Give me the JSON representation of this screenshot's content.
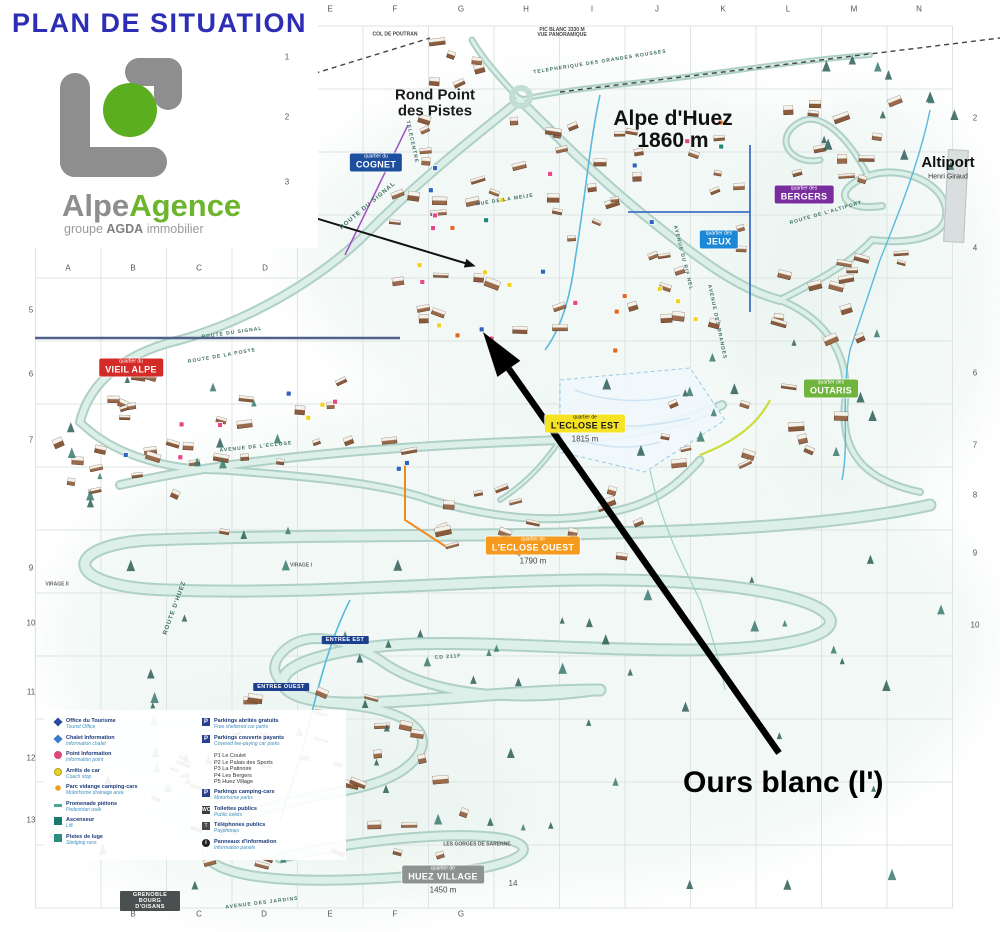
{
  "header": {
    "title": "PLAN DE SITUATION",
    "logo": {
      "name1": "Alpe",
      "name2": "Agence",
      "sub_pre": "groupe ",
      "sub_bold": "AGDA",
      "sub_post": " immobilier"
    }
  },
  "annotation": {
    "label": "Ours blanc (l')",
    "x": 683,
    "y": 766,
    "arrow": {
      "x1": 779,
      "y1": 753,
      "x2": 483,
      "y2": 332
    },
    "pointer_points": [
      [
        222,
        148
      ],
      [
        222,
        190
      ],
      [
        468,
        264
      ]
    ]
  },
  "map": {
    "places": [
      {
        "id": "rond-point",
        "lines": [
          "Rond Point",
          "des Pistes"
        ],
        "x": 435,
        "y": 103,
        "size": 15,
        "weight": "600",
        "color": "#1a1a1a"
      },
      {
        "id": "alpe-dhuez",
        "lines": [
          "Alpe d'Huez",
          "1860 m"
        ],
        "x": 673,
        "y": 130,
        "size": 21,
        "weight": "bold",
        "color": "#111"
      },
      {
        "id": "altiport",
        "lines": [
          "Altiport"
        ],
        "x": 948,
        "y": 163,
        "size": 15,
        "weight": "bold",
        "color": "#111"
      },
      {
        "id": "altiport-sub",
        "lines": [
          "Henri Giraud"
        ],
        "x": 948,
        "y": 177,
        "size": 7,
        "weight": "normal",
        "color": "#333"
      },
      {
        "id": "col-de-poutran",
        "lines": [
          "COL DE POUTRAN"
        ],
        "x": 395,
        "y": 35,
        "size": 5,
        "weight": "bold",
        "color": "#444"
      },
      {
        "id": "pic-blanc",
        "lines": [
          "PIC BLANC 3330 M",
          "VUE PANORAMIQUE"
        ],
        "x": 562,
        "y": 33,
        "size": 5,
        "weight": "bold",
        "color": "#444"
      },
      {
        "id": "gorges-sarenne",
        "lines": [
          "LES GORGES DE SARENNE"
        ],
        "x": 477,
        "y": 845,
        "size": 5,
        "weight": "bold",
        "color": "#555"
      },
      {
        "id": "virage-2",
        "lines": [
          "VIRAGE II"
        ],
        "x": 57,
        "y": 585,
        "size": 5,
        "weight": "bold",
        "color": "#666"
      },
      {
        "id": "virage-1",
        "lines": [
          "VIRAGE I"
        ],
        "x": 301,
        "y": 566,
        "size": 5,
        "weight": "bold",
        "color": "#666"
      },
      {
        "id": "inner-14",
        "lines": [
          "14"
        ],
        "x": 513,
        "y": 884,
        "size": 8,
        "weight": "normal",
        "color": "#555"
      }
    ],
    "road_labels": [
      {
        "text": "TELEPHERIQUE DES GRANDES ROUSSES",
        "x": 600,
        "y": 62,
        "rot": -9,
        "size": 5
      },
      {
        "text": "TELECENTRE",
        "x": 412,
        "y": 142,
        "rot": 78,
        "size": 5
      },
      {
        "text": "ROUTE DU SIGNAL",
        "x": 368,
        "y": 206,
        "rot": -40,
        "size": 6
      },
      {
        "text": "ROUTE DU SIGNAL",
        "x": 232,
        "y": 333,
        "rot": -8,
        "size": 5
      },
      {
        "text": "ROUTE DE LA POSTE",
        "x": 222,
        "y": 356,
        "rot": -10,
        "size": 5
      },
      {
        "text": "RUE DE LA MEIJE",
        "x": 505,
        "y": 200,
        "rot": -9,
        "size": 5
      },
      {
        "text": "AVENUE DU RIF NEL",
        "x": 683,
        "y": 258,
        "rot": 76,
        "size": 5
      },
      {
        "text": "AVENUE DES BRANDES",
        "x": 717,
        "y": 322,
        "rot": 78,
        "size": 5
      },
      {
        "text": "AVENUE DE L'ECLOSE",
        "x": 256,
        "y": 447,
        "rot": -6,
        "size": 5
      },
      {
        "text": "ROUTE DE L'ALTIPORT",
        "x": 826,
        "y": 213,
        "rot": -16,
        "size": 5
      },
      {
        "text": "ROUTE D'HUEZ",
        "x": 175,
        "y": 608,
        "rot": -70,
        "size": 6
      },
      {
        "text": "AVENUE DES JARDINS",
        "x": 262,
        "y": 903,
        "rot": -7,
        "size": 5
      },
      {
        "text": "CD 211F",
        "x": 448,
        "y": 657,
        "rot": -4,
        "size": 5
      }
    ],
    "quarters": [
      {
        "id": "cognet",
        "small": "quartier du",
        "name": "COGNET",
        "bg": "#1d4f9e",
        "fg": "#ffffff",
        "x": 376,
        "y": 163
      },
      {
        "id": "jeux",
        "small": "quartier des",
        "name": "JEUX",
        "bg": "#1b87d6",
        "fg": "#ffffff",
        "x": 719,
        "y": 240
      },
      {
        "id": "bergers",
        "small": "quartier des",
        "name": "BERGERS",
        "bg": "#7a2d9e",
        "fg": "#ffffff",
        "x": 804,
        "y": 195
      },
      {
        "id": "vieil-alpe",
        "small": "quartier du",
        "name": "VIEIL ALPE",
        "bg": "#d42a28",
        "fg": "#ffffff",
        "x": 131,
        "y": 368
      },
      {
        "id": "outaris",
        "small": "quartier des",
        "name": "OUTARIS",
        "bg": "#6fb43c",
        "fg": "#ffffff",
        "x": 831,
        "y": 389
      },
      {
        "id": "eclose-est",
        "small": "quartier de",
        "name": "L'ECLOSE EST",
        "bg": "#f6e324",
        "fg": "#1a1a1a",
        "x": 585,
        "y": 429,
        "alt": "1815 m"
      },
      {
        "id": "eclose-ouest",
        "small": "quartier de",
        "name": "L'ECLOSE OUEST",
        "bg": "#f59a1c",
        "fg": "#ffffff",
        "x": 533,
        "y": 551,
        "alt": "1790 m"
      },
      {
        "id": "huez-village",
        "small": "quartier de",
        "name": "HUEZ VILLAGE",
        "bg": "#8d9393",
        "fg": "#ffffff",
        "x": 443,
        "y": 880,
        "alt": "1450 m"
      }
    ],
    "chips": [
      {
        "id": "entree-est",
        "text": "ENTREE EST",
        "x": 345,
        "y": 640
      },
      {
        "id": "entree-ouest",
        "text": "ENTREE OUEST",
        "x": 281,
        "y": 687
      },
      {
        "id": "grenoble",
        "text": "GRENOBLE BOURG D'OISANS",
        "x": 150,
        "y": 901
      }
    ],
    "grid": {
      "top_letters": [
        {
          "t": "E",
          "x": 330
        },
        {
          "t": "F",
          "x": 395
        },
        {
          "t": "G",
          "x": 461
        },
        {
          "t": "H",
          "x": 526
        },
        {
          "t": "I",
          "x": 592
        },
        {
          "t": "J",
          "x": 657
        },
        {
          "t": "K",
          "x": 723
        },
        {
          "t": "L",
          "x": 788
        },
        {
          "t": "M",
          "x": 854
        },
        {
          "t": "N",
          "x": 919
        }
      ],
      "bottom_letters": [
        {
          "t": "B",
          "x": 133
        },
        {
          "t": "C",
          "x": 199
        },
        {
          "t": "D",
          "x": 264
        },
        {
          "t": "E",
          "x": 330
        },
        {
          "t": "F",
          "x": 395
        },
        {
          "t": "G",
          "x": 461
        }
      ],
      "inner_letters": [
        {
          "t": "A",
          "x": 68,
          "y": 268
        },
        {
          "t": "B",
          "x": 133,
          "y": 268
        },
        {
          "t": "C",
          "x": 199,
          "y": 268
        },
        {
          "t": "D",
          "x": 265,
          "y": 268
        }
      ],
      "left_numbers": [
        {
          "t": "5",
          "y": 310
        },
        {
          "t": "6",
          "y": 374
        },
        {
          "t": "7",
          "y": 440
        },
        {
          "t": "9",
          "y": 568
        },
        {
          "t": "10",
          "y": 623
        },
        {
          "t": "11",
          "y": 692
        },
        {
          "t": "12",
          "y": 758
        },
        {
          "t": "13",
          "y": 820
        }
      ],
      "inner_numbers": [
        {
          "t": "1",
          "y": 57
        },
        {
          "t": "2",
          "y": 117
        },
        {
          "t": "3",
          "y": 182
        }
      ],
      "right_numbers": [
        {
          "t": "2",
          "y": 118
        },
        {
          "t": "4",
          "y": 248
        },
        {
          "t": "6",
          "y": 373
        },
        {
          "t": "7",
          "y": 445
        },
        {
          "t": "8",
          "y": 495
        },
        {
          "t": "9",
          "y": 553
        },
        {
          "t": "10",
          "y": 625
        }
      ]
    }
  },
  "legend": {
    "left": [
      {
        "icon": "diamond-blue",
        "fr": "Office du Tourisme",
        "en": "Tourist Office"
      },
      {
        "icon": "diamond-lightblue",
        "fr": "Chalet Information",
        "en": "Information chalet"
      },
      {
        "icon": "circle-red",
        "fr": "Point Information",
        "en": "Information point"
      },
      {
        "icon": "circle-yellow",
        "fr": "Arrêts de car",
        "en": "Coach stop"
      },
      {
        "icon": "dot-orange",
        "fr": "Parc vidange camping-cars",
        "en": "Motorhome drainage area"
      },
      {
        "icon": "dash-teal",
        "fr": "Promenade piétons",
        "en": "Pedestrian walk"
      },
      {
        "icon": "square-teal",
        "fr": "Ascenseur",
        "en": "Lift"
      },
      {
        "icon": "square-teal2",
        "fr": "Pistes de luge",
        "en": "Sledging runs"
      }
    ],
    "right": [
      {
        "icon": "parking-free",
        "glyph": "P",
        "fr": "Parkings abrités gratuits",
        "en": "Free sheltered car parks"
      },
      {
        "icon": "parking-paid",
        "glyph": "P",
        "fr": "Parkings couverts payants",
        "en": "Covered fee-paying car parks"
      }
    ],
    "parking_list": [
      "P1  Le Coulet",
      "P2  Le Palais des Sports",
      "P3  La Patinoire",
      "P4  Les Bergers",
      "P5  Huez Village"
    ],
    "right2": [
      {
        "icon": "parking-camper",
        "glyph": "P",
        "fr": "Parkings camping-cars",
        "en": "Motorhome parks"
      },
      {
        "icon": "wc",
        "glyph": "WC",
        "fr": "Toilettes publics",
        "en": "Public toilets"
      },
      {
        "icon": "phone",
        "glyph": "T",
        "fr": "Téléphones publics",
        "en": "Payphones"
      },
      {
        "icon": "info",
        "glyph": "i",
        "fr": "Panneaux d'information",
        "en": "Information panels"
      }
    ]
  }
}
